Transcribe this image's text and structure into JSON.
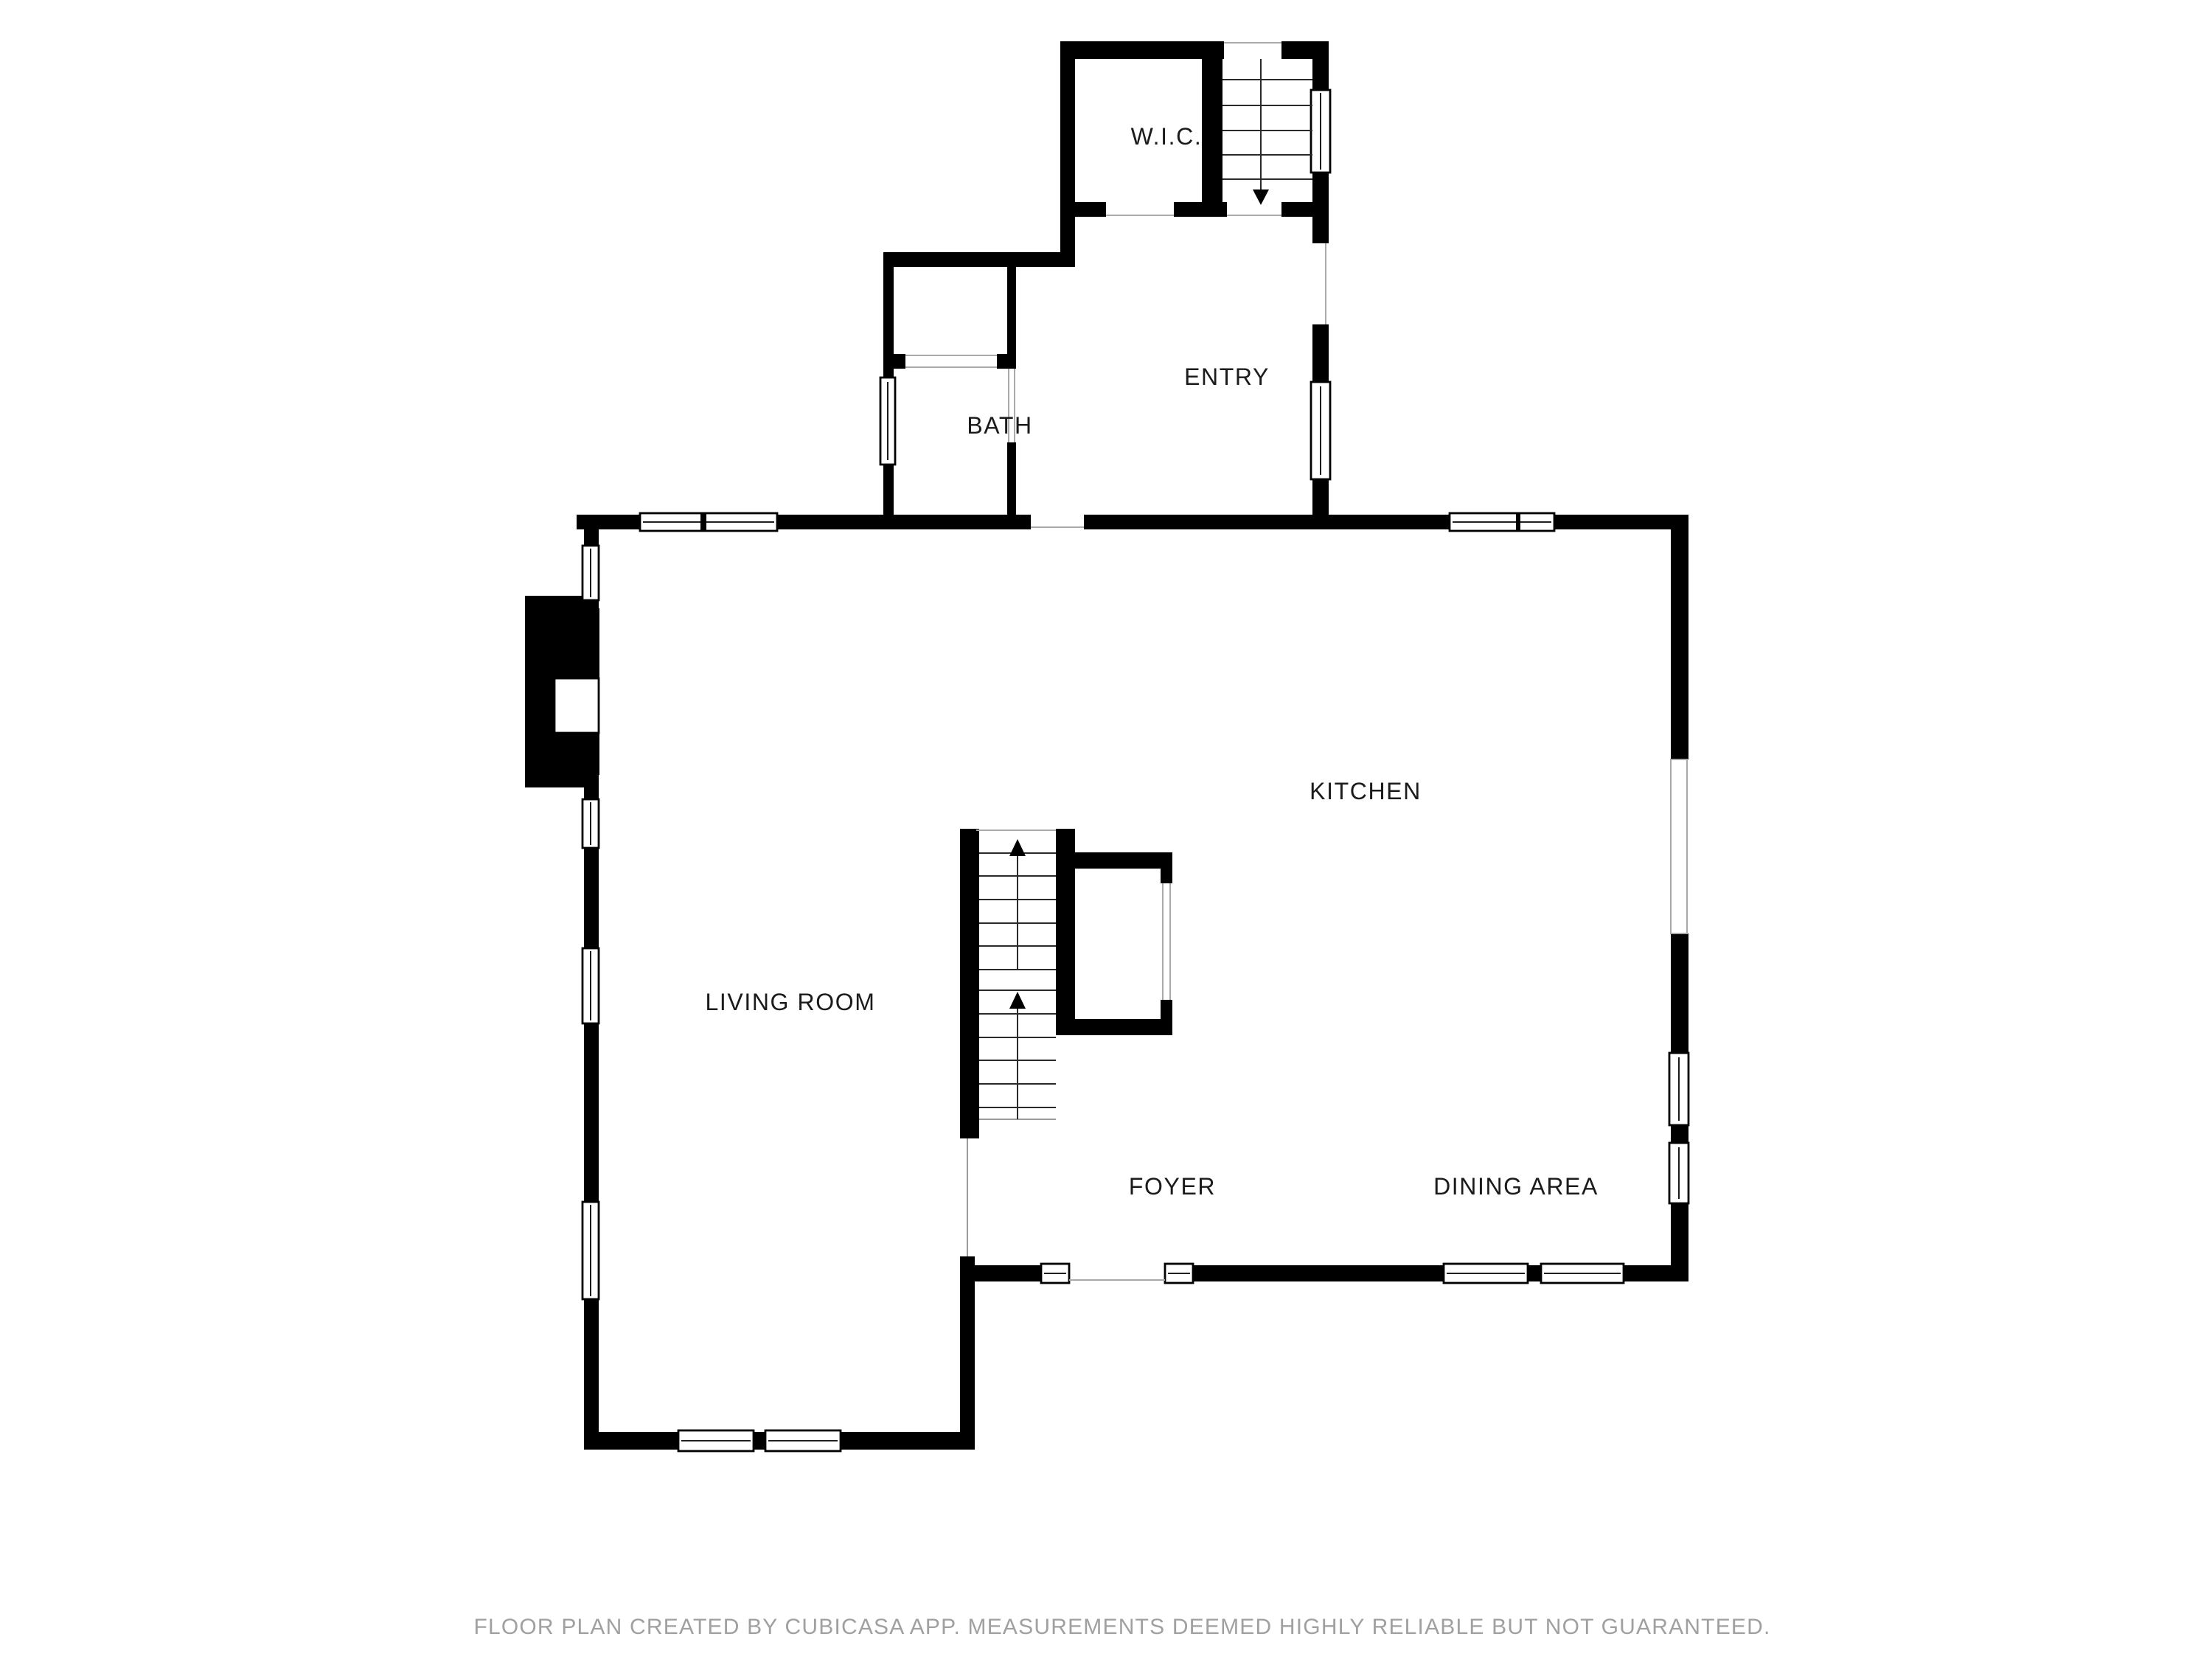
{
  "document": {
    "type": "floor-plan",
    "background": "#ffffff"
  },
  "rooms": {
    "wic": "W.I.C.",
    "entry": "ENTRY",
    "bath": "BATH",
    "kitchen": "KITCHEN",
    "living_room": "LIVING ROOM",
    "foyer": "FOYER",
    "dining_area": "DINING AREA"
  },
  "symbols": {
    "stairs_down_arrow": "down-arrow",
    "stairs_up_arrow": "up-arrow",
    "fireplace": "hatched-fireplace",
    "window": "double-line-window"
  },
  "colors": {
    "wall": "#000000",
    "label_text": "#1b1b1b",
    "footer_text": "#a0a0a0",
    "opening_line": "#aaaaaa"
  },
  "footer": {
    "disclaimer": "FLOOR PLAN CREATED BY CUBICASA APP. MEASUREMENTS DEEMED HIGHLY RELIABLE BUT NOT GUARANTEED."
  }
}
